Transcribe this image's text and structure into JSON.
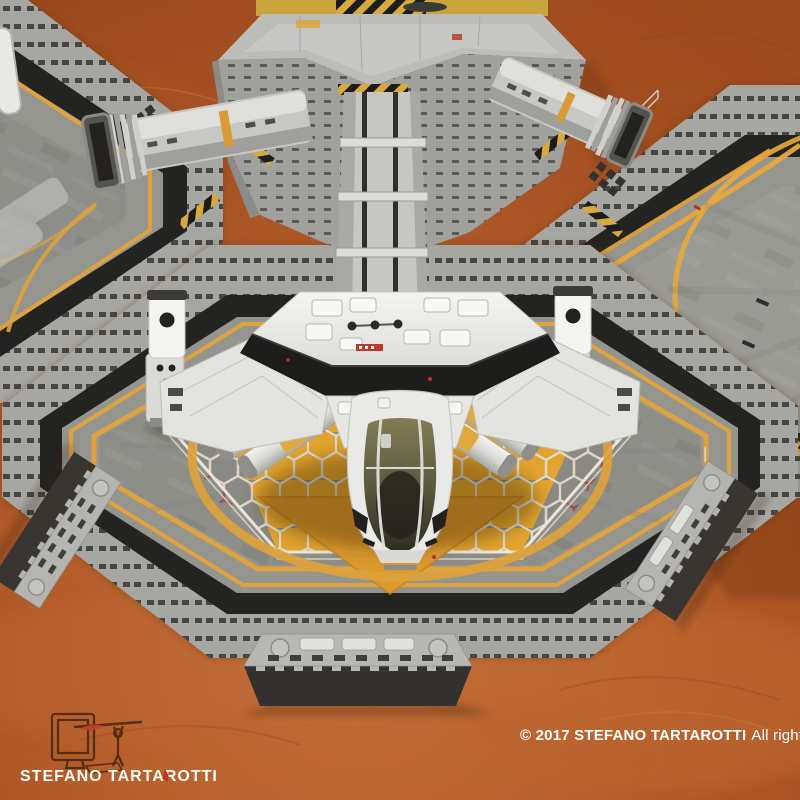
{
  "watermark": {
    "artist": "STEFANO TARTAROTTI"
  },
  "footer": {
    "copyright": "© 2017 STEFANO TARTAROTTI",
    "rights": "All rights reserved"
  },
  "palette": {
    "mars_ground": "#b25a28",
    "mars_dark": "#8f4520",
    "mars_light": "#c9773e",
    "pad_concrete": "#8e8e89",
    "rim_blocks": "#a6a6a2",
    "hazard_black": "#232322",
    "accent_yellow": "#e2a23a",
    "hex_orange": "#e2a42e",
    "hex_line_red": "#9c4a3c",
    "hex_line_white": "#e7e2d6",
    "ship_white": "#ececea",
    "canopy_olive": "#6f6a4a",
    "collar_black": "#1d1d1b"
  },
  "scene": {
    "elements": [
      "mars-terrain",
      "central-hub",
      "corridor-main",
      "corridor-left",
      "corridor-right",
      "landing-pad-left",
      "landing-pad-center",
      "landing-pad-right",
      "honeycomb-zone",
      "shuttle-spacecraft",
      "booster-pods",
      "light-towers",
      "boarding-ramps",
      "artist-logo"
    ]
  }
}
